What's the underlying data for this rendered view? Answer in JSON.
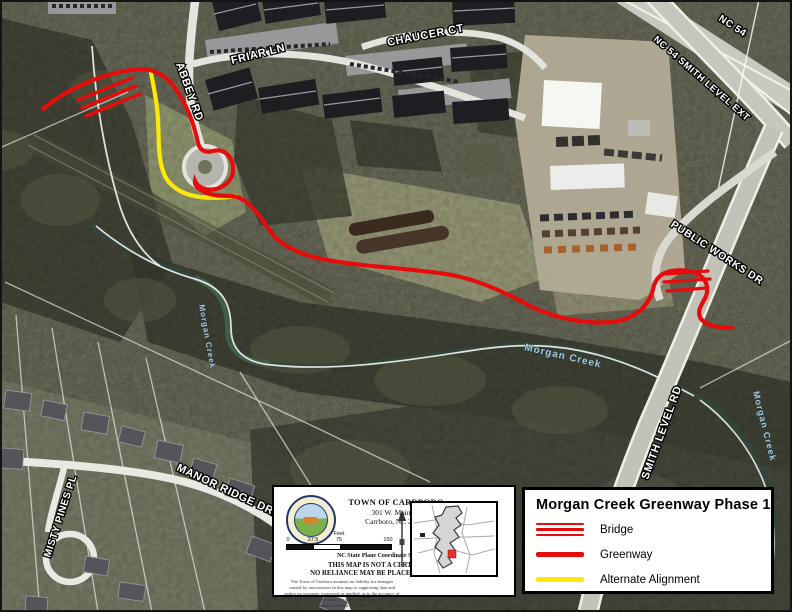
{
  "legend": {
    "title": "Morgan Creek Greenway Phase 1",
    "items": [
      {
        "label": "Bridge",
        "symbol": "bridge-hatch-icon",
        "color": "#e60c0c"
      },
      {
        "label": "Greenway",
        "symbol": "line-icon",
        "color": "#e60c0c"
      },
      {
        "label": "Alternate Alignment",
        "symbol": "line-icon",
        "color": "#ffe70a"
      }
    ]
  },
  "info_box": {
    "org_name": "TOWN OF CARRBORO",
    "address_line1": "301 W. Main St.",
    "address_line2": "Carrboro, NC 27510",
    "scale": {
      "unit_label": "Feet",
      "ticks": [
        "0",
        "37.5",
        "75",
        "150"
      ]
    },
    "coordinate_system": "NC State Plane Coordinate System (NAD83)",
    "disclaimer_bold_line1": "THIS MAP IS NOT A CERTIFIED SURVEY",
    "disclaimer_bold_line2": "NO RELIANCE MAY BE PLACED IN ITS ACCURACY",
    "disclaimer_fine": "The Town of Carrboro assumes no liability for damages caused by inaccuracies in this map or supporting data and makes no warranty, expressed or implied, as to the accuracy of the information presented. The fact of distribution does not constitute such a warranty."
  },
  "map_labels": {
    "abbey_rd": "ABBEY RD",
    "friar_ln": "FRIAR LN",
    "chaucer_ct": "CHAUCER CT",
    "nc54": "NC 54",
    "nc54_ext": "NC 54 SMITH LEVEL EXT",
    "public_works_dr": "PUBLIC WORKS DR",
    "smith_level_rd": "SMITH LEVEL RD",
    "manor_ridge_dr": "MANOR RIDGE DR",
    "misty_pines_pl": "MISTY PINES PL",
    "morgan_creek": "Morgan Creek"
  },
  "colors": {
    "greenway": "#e60c0c",
    "alternate_alignment": "#ffe70a",
    "creek_label": "#a7c9dc",
    "locator_marker": "#e8312a"
  }
}
